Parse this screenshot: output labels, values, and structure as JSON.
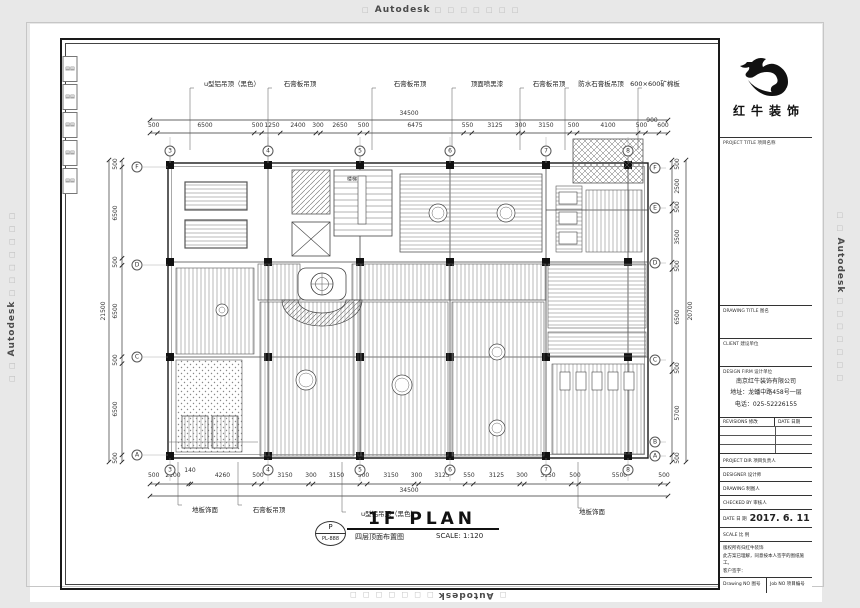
{
  "watermark": {
    "brand": "Autodesk",
    "squares_before": "□",
    "squares_after": "□ □ □ □ □ □ □",
    "squares_side_before": "□ □",
    "squares_side_after": "□ □ □ □ □ □ □"
  },
  "title_block": {
    "logo_name": "红牛装饰",
    "project_title": "PROJECT TITLE  项目名称",
    "drawing_title": "DRAWING TITLE  图名",
    "client": "CLIENT  建设单位",
    "design_firm": "DESIGN FIRM  设计单位",
    "company": "南京红牛装饰有限公司",
    "address": "地址：龙蟠中路458号一层",
    "phone": "电话：025-52226155",
    "revisions": "REVISIONS  修改",
    "rev_date": "DATE  日期",
    "project_dir": "PROJECT DIR  项目负责人",
    "designer": "DESIGNER  设计师",
    "drafter": "DRAWING  制图人",
    "checked": "CHECKED BY  审核人",
    "date_label": "DATE  日 期",
    "date_value": "2017. 6. 11",
    "scale_label": "SCALE  比 例",
    "note1": "版权所有归红牛装饰",
    "note2": "此方案已理解，同意按本人签字的图纸施工。",
    "note3": "客户签字：",
    "drawing_no": "Drawing NO  图号",
    "job_no": "Job NO  项目编号"
  },
  "plan": {
    "title": "1F PLAN",
    "subtitle": "四层顶面布置图",
    "scale_note": "SCALE: 1:120",
    "ref_top": "P",
    "ref_no": "PL-888",
    "labels": [
      {
        "t": "500",
        "x": 153.7,
        "y": 125.5,
        "c": "dim"
      },
      {
        "t": "6500",
        "x": 205,
        "y": 125.5,
        "c": "dim"
      },
      {
        "t": "500",
        "x": 257.5,
        "y": 125.5,
        "c": "dim"
      },
      {
        "t": "1250",
        "x": 272,
        "y": 125.5,
        "c": "dim"
      },
      {
        "t": "2400",
        "x": 298,
        "y": 125.5,
        "c": "dim"
      },
      {
        "t": "300",
        "x": 318,
        "y": 125.5,
        "c": "dim"
      },
      {
        "t": "2650",
        "x": 340,
        "y": 125.5,
        "c": "dim"
      },
      {
        "t": "500",
        "x": 363.5,
        "y": 125.5,
        "c": "dim"
      },
      {
        "t": "6475",
        "x": 415,
        "y": 125.5,
        "c": "dim"
      },
      {
        "t": "550",
        "x": 467.5,
        "y": 125.5,
        "c": "dim"
      },
      {
        "t": "3125",
        "x": 495,
        "y": 125.5,
        "c": "dim"
      },
      {
        "t": "300",
        "x": 520.5,
        "y": 125.5,
        "c": "dim"
      },
      {
        "t": "3150",
        "x": 546,
        "y": 125.5,
        "c": "dim"
      },
      {
        "t": "500",
        "x": 573.5,
        "y": 125.5,
        "c": "dim"
      },
      {
        "t": "4100",
        "x": 608,
        "y": 125.5,
        "c": "dim"
      },
      {
        "t": "500",
        "x": 641.5,
        "y": 125.5,
        "c": "dim"
      },
      {
        "t": "900",
        "x": 652,
        "y": 121,
        "c": "dim"
      },
      {
        "t": "600",
        "x": 663,
        "y": 125.5,
        "c": "dim"
      },
      {
        "t": "34500",
        "x": 409,
        "y": 114,
        "c": "dim"
      },
      {
        "t": "500",
        "x": 153.7,
        "y": 476,
        "c": "dim"
      },
      {
        "t": "2100",
        "x": 173,
        "y": 476,
        "c": "dim"
      },
      {
        "t": "140",
        "x": 190,
        "y": 471,
        "c": "dim"
      },
      {
        "t": "4260",
        "x": 222.5,
        "y": 476,
        "c": "dim"
      },
      {
        "t": "500",
        "x": 258,
        "y": 476,
        "c": "dim"
      },
      {
        "t": "3150",
        "x": 285,
        "y": 476,
        "c": "dim"
      },
      {
        "t": "300",
        "x": 311,
        "y": 476,
        "c": "dim"
      },
      {
        "t": "3150",
        "x": 336.5,
        "y": 476,
        "c": "dim"
      },
      {
        "t": "500",
        "x": 363.5,
        "y": 476,
        "c": "dim"
      },
      {
        "t": "3150",
        "x": 391,
        "y": 476,
        "c": "dim"
      },
      {
        "t": "300",
        "x": 416.5,
        "y": 476,
        "c": "dim"
      },
      {
        "t": "3125",
        "x": 442,
        "y": 476,
        "c": "dim"
      },
      {
        "t": "550",
        "x": 469,
        "y": 476,
        "c": "dim"
      },
      {
        "t": "3125",
        "x": 496.5,
        "y": 476,
        "c": "dim"
      },
      {
        "t": "300",
        "x": 522,
        "y": 476,
        "c": "dim"
      },
      {
        "t": "3150",
        "x": 548,
        "y": 476,
        "c": "dim"
      },
      {
        "t": "500",
        "x": 575,
        "y": 476,
        "c": "dim"
      },
      {
        "t": "5500",
        "x": 619.5,
        "y": 476,
        "c": "dim"
      },
      {
        "t": "500",
        "x": 664,
        "y": 476,
        "c": "dim"
      },
      {
        "t": "34500",
        "x": 409,
        "y": 491,
        "c": "dim"
      },
      {
        "t": "500",
        "x": 116,
        "y": 163.5,
        "c": "dim",
        "r": -90
      },
      {
        "t": "6500",
        "x": 116,
        "y": 212.7,
        "c": "dim",
        "r": -90
      },
      {
        "t": "500",
        "x": 116,
        "y": 261.8,
        "c": "dim",
        "r": -90
      },
      {
        "t": "6500",
        "x": 116,
        "y": 311,
        "c": "dim",
        "r": -90
      },
      {
        "t": "500",
        "x": 116,
        "y": 360.1,
        "c": "dim",
        "r": -90
      },
      {
        "t": "6500",
        "x": 116,
        "y": 409.3,
        "c": "dim",
        "r": -90
      },
      {
        "t": "500",
        "x": 116,
        "y": 458.4,
        "c": "dim",
        "r": -90
      },
      {
        "t": "21500",
        "x": 104,
        "y": 311,
        "c": "dim",
        "r": -90
      },
      {
        "t": "500",
        "x": 678,
        "y": 163.6,
        "c": "dim",
        "r": -90
      },
      {
        "t": "2500",
        "x": 678,
        "y": 185.5,
        "c": "dim",
        "r": -90
      },
      {
        "t": "500",
        "x": 678,
        "y": 207.4,
        "c": "dim",
        "r": -90
      },
      {
        "t": "3500",
        "x": 678,
        "y": 236.6,
        "c": "dim",
        "r": -90
      },
      {
        "t": "500",
        "x": 678,
        "y": 265.8,
        "c": "dim",
        "r": -90
      },
      {
        "t": "6500",
        "x": 678,
        "y": 316.9,
        "c": "dim",
        "r": -90
      },
      {
        "t": "500",
        "x": 678,
        "y": 367.9,
        "c": "dim",
        "r": -90
      },
      {
        "t": "5700",
        "x": 678,
        "y": 413.2,
        "c": "dim",
        "r": -90
      },
      {
        "t": "500",
        "x": 678,
        "y": 458.4,
        "c": "dim",
        "r": -90
      },
      {
        "t": "20700",
        "x": 691,
        "y": 311,
        "c": "dim",
        "r": -90
      },
      {
        "t": "3",
        "x": 170,
        "y": 151,
        "c": "bub"
      },
      {
        "t": "4",
        "x": 268,
        "y": 151,
        "c": "bub"
      },
      {
        "t": "5",
        "x": 360,
        "y": 151,
        "c": "bub"
      },
      {
        "t": "6",
        "x": 450,
        "y": 151,
        "c": "bub"
      },
      {
        "t": "7",
        "x": 546,
        "y": 151,
        "c": "bub"
      },
      {
        "t": "8",
        "x": 628,
        "y": 151,
        "c": "bub"
      },
      {
        "t": "3",
        "x": 170,
        "y": 470,
        "c": "bub"
      },
      {
        "t": "4",
        "x": 268,
        "y": 470,
        "c": "bub"
      },
      {
        "t": "5",
        "x": 360,
        "y": 470,
        "c": "bub"
      },
      {
        "t": "6",
        "x": 450,
        "y": 470,
        "c": "bub"
      },
      {
        "t": "7",
        "x": 546,
        "y": 470,
        "c": "bub"
      },
      {
        "t": "8",
        "x": 628,
        "y": 470,
        "c": "bub"
      },
      {
        "t": "F",
        "x": 137,
        "y": 167,
        "c": "bub"
      },
      {
        "t": "D",
        "x": 137,
        "y": 265,
        "c": "bub"
      },
      {
        "t": "C",
        "x": 137,
        "y": 357,
        "c": "bub"
      },
      {
        "t": "A",
        "x": 137,
        "y": 455,
        "c": "bub"
      },
      {
        "t": "F",
        "x": 655,
        "y": 168,
        "c": "bub"
      },
      {
        "t": "E",
        "x": 655,
        "y": 208,
        "c": "bub"
      },
      {
        "t": "D",
        "x": 655,
        "y": 263,
        "c": "bub"
      },
      {
        "t": "C",
        "x": 655,
        "y": 360,
        "c": "bub"
      },
      {
        "t": "B",
        "x": 655,
        "y": 442,
        "c": "bub"
      },
      {
        "t": "A",
        "x": 655,
        "y": 456,
        "c": "bub"
      },
      {
        "t": "u型铝吊顶（黑色）",
        "x": 232,
        "y": 84,
        "c": "anno"
      },
      {
        "t": "石膏板吊顶",
        "x": 300,
        "y": 84,
        "c": "anno"
      },
      {
        "t": "石膏板吊顶",
        "x": 410,
        "y": 84,
        "c": "anno"
      },
      {
        "t": "顶面喷黑漆",
        "x": 487,
        "y": 84,
        "c": "anno"
      },
      {
        "t": "石膏板吊顶",
        "x": 549,
        "y": 84,
        "c": "anno"
      },
      {
        "t": "防水石膏板吊顶",
        "x": 601,
        "y": 84,
        "c": "anno"
      },
      {
        "t": "600×600矿棉板",
        "x": 655,
        "y": 84,
        "c": "anno"
      },
      {
        "t": "地板饰面",
        "x": 205,
        "y": 510,
        "c": "anno"
      },
      {
        "t": "石膏板吊顶",
        "x": 269,
        "y": 510,
        "c": "anno"
      },
      {
        "t": "u型铝吊顶（黑色）",
        "x": 389,
        "y": 514,
        "c": "anno"
      },
      {
        "t": "地板饰面",
        "x": 592,
        "y": 512,
        "c": "anno"
      },
      {
        "t": "楼梯",
        "x": 352,
        "y": 180,
        "c": "tiny"
      },
      {
        "t": "▤▤",
        "x": 70,
        "y": 69,
        "c": "bind"
      },
      {
        "t": "▤▤",
        "x": 70,
        "y": 97,
        "c": "bind"
      },
      {
        "t": "▤▤",
        "x": 70,
        "y": 125,
        "c": "bind"
      },
      {
        "t": "▤▤",
        "x": 70,
        "y": 153,
        "c": "bind"
      },
      {
        "t": "▤▤",
        "x": 70,
        "y": 181,
        "c": "bind"
      }
    ]
  }
}
